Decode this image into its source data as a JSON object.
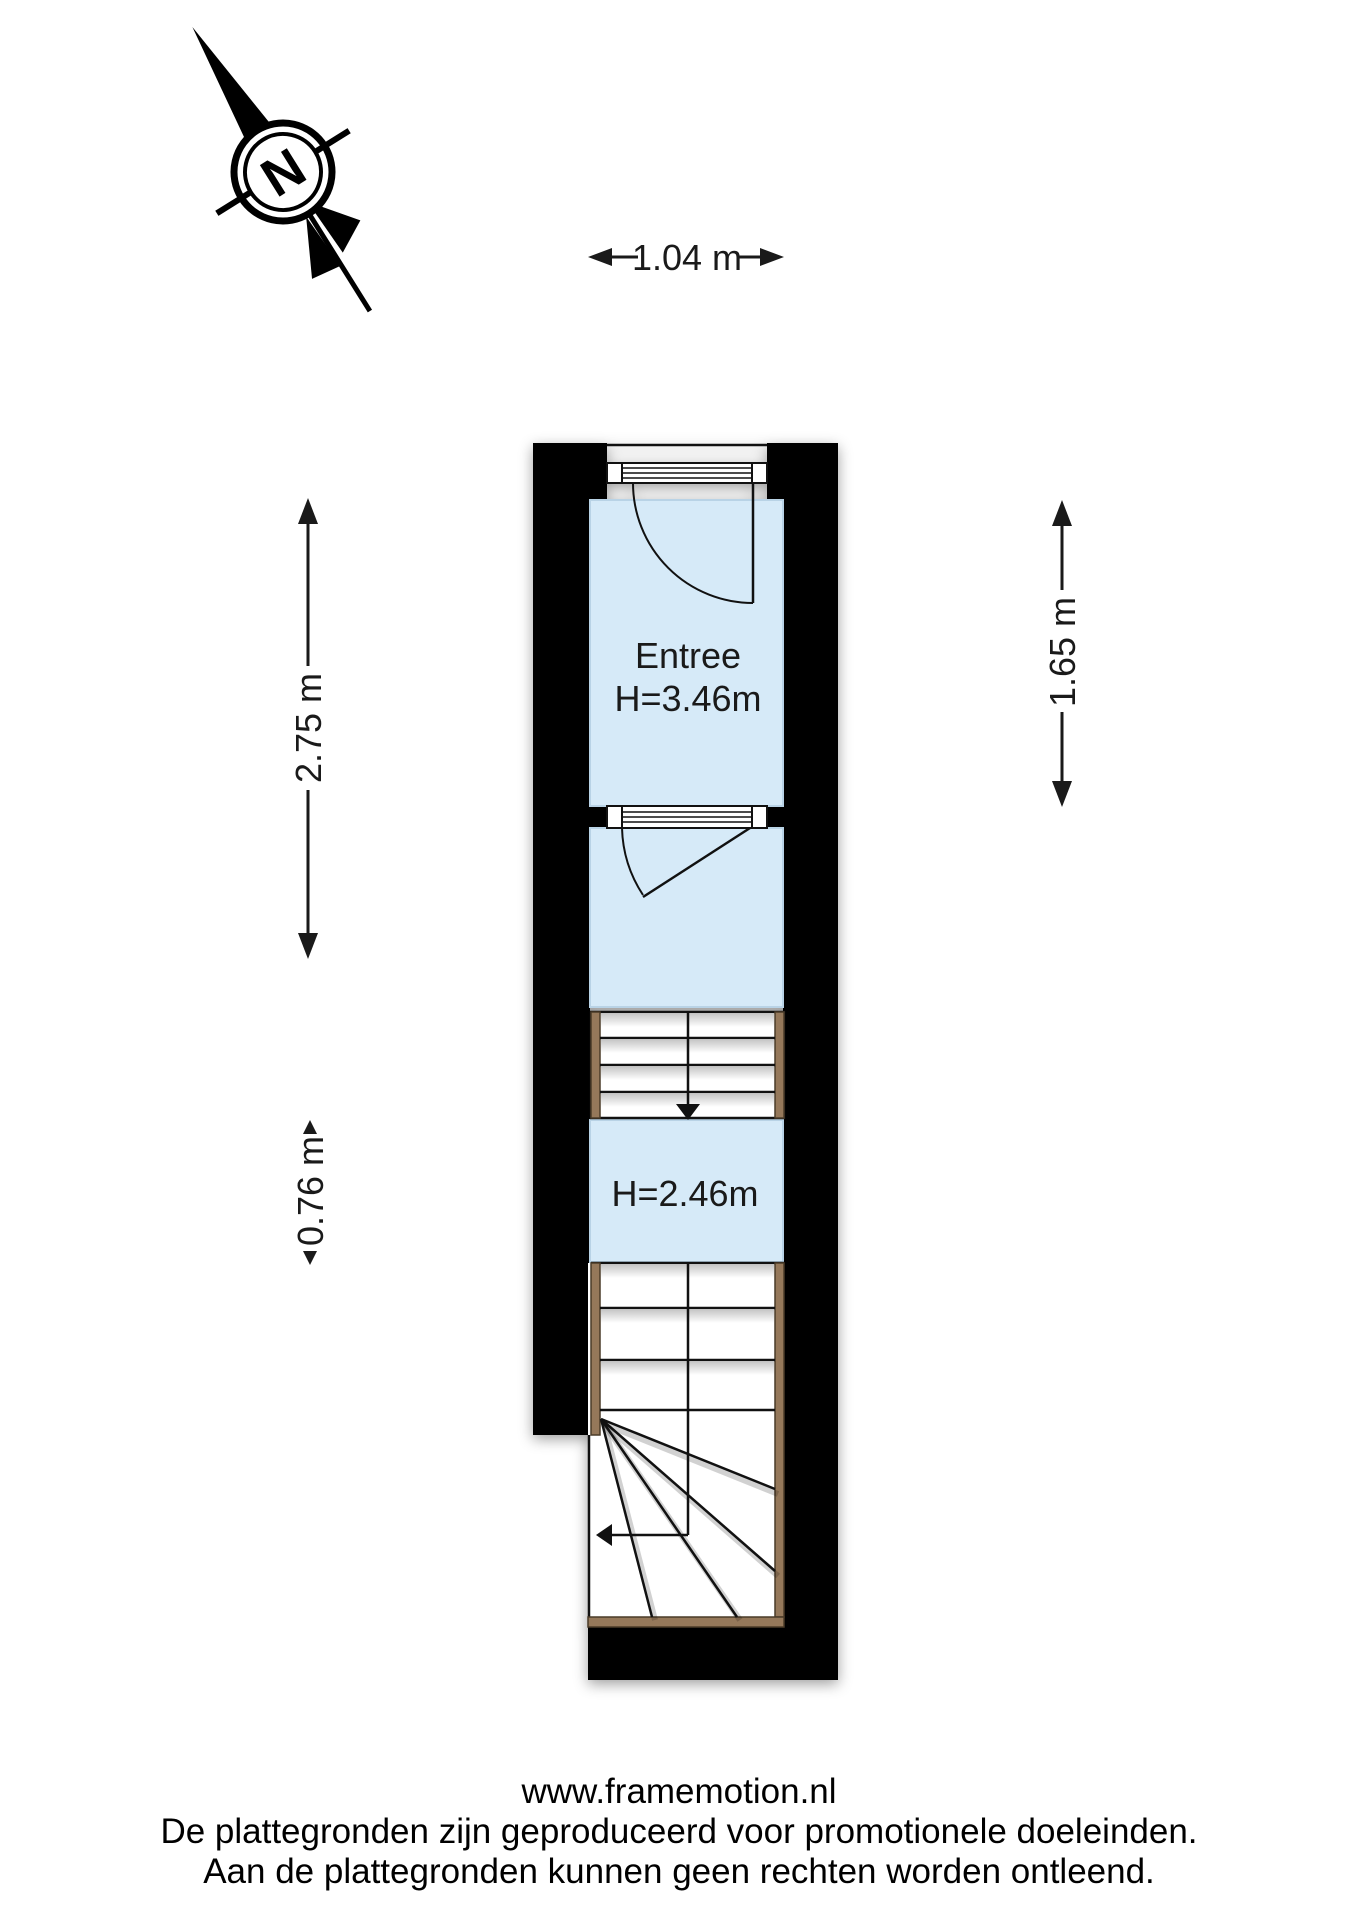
{
  "compass": {
    "north_letter": "N"
  },
  "rooms": {
    "entree": {
      "name": "Entree",
      "ceiling_height": "H=3.46m"
    },
    "lower_hall": {
      "ceiling_height": "H=2.46m"
    }
  },
  "dimensions": {
    "width_top": "1.04 m",
    "left_upper": "2.75 m",
    "left_lower": "0.76 m",
    "right": "1.65 m"
  },
  "footer": {
    "website": "www.framemotion.nl",
    "disclaimer_line1": "De plattegronden zijn geproduceerd voor promotionele doeleinden.",
    "disclaimer_line2": "Aan de plattegronden kunnen geen rechten worden ontleend."
  },
  "colors": {
    "wall": "#000000",
    "room_fill": "#d6eaf8",
    "stair_wood": "#95785a",
    "text": "#1a1a1a"
  }
}
